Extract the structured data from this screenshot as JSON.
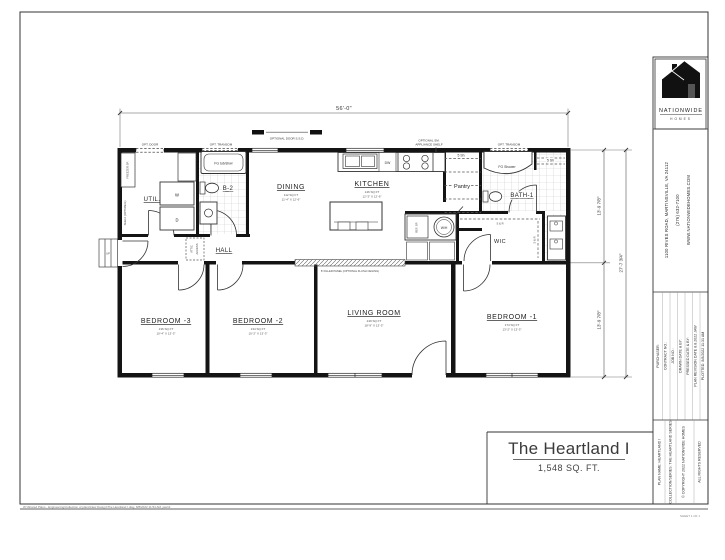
{
  "plan_title": {
    "name": "The Heartland I",
    "area": "1,548 SQ. FT."
  },
  "dims": {
    "width": "56'-0\"",
    "module_front": "13'-9 7/8\"",
    "module_rear": "13'-9 7/8\"",
    "overall_depth": "27'-7 3/4\""
  },
  "rooms": {
    "dining": {
      "label": "DINING",
      "area": "112 SQ FT",
      "size": "11'-4\" X 12'-6\""
    },
    "kitchen": {
      "label": "KITCHEN",
      "area": "146 SQ FT",
      "size": "12'-3\" X 12'-6\""
    },
    "living": {
      "label": "LIVING ROOM",
      "area": "249 SQ FT",
      "size": "18'-9\" X 13'-3\""
    },
    "bed1": {
      "label": "BEDROOM -1",
      "area": "174 SQ FT",
      "size": "13'-2\" X 13'-3\""
    },
    "bed2": {
      "label": "BEDROOM -2",
      "area": "134 SQ FT",
      "size": "10'-2\" X 13'-3\""
    },
    "bed3": {
      "label": "BEDROOM -3",
      "area": "136 SQ FT",
      "size": "10'-4\" X 13'-3\""
    },
    "util": {
      "label": "UTIL."
    },
    "hall": {
      "label": "HALL"
    },
    "b2": {
      "label": "B-2"
    },
    "bath1": {
      "label": "BATH-1"
    },
    "wic": {
      "label": "WIC"
    },
    "pantry": {
      "label": "Pantry"
    }
  },
  "fixtures": {
    "washer": "W",
    "dryer": "D",
    "dishwasher": "DW",
    "water_heater": "W/H",
    "fridge": "REF. SP.",
    "tub": "FG tub/shwr",
    "shower": "FG Shower",
    "shelves_5": "5 Sh",
    "shelf_rod": "S & R",
    "attic_1": "ATTIC",
    "attic_2": "ACCESS",
    "up": "UP",
    "freezer": "FREEZER SP.",
    "shelf_opt": "SHELF (OPTIONAL)"
  },
  "notes": {
    "opt_door_ssd": "OPTIONAL DOOR S.S.D.",
    "appliance_1": "OPTIONAL SM.",
    "appliance_2": "APPLIANCE SHELF",
    "filler": "8' FILLER PANEL (OPTIONAL FLUSH CEILING)",
    "opt_door": "OPT. DOOR",
    "opt_transom": "OPT. TRANSOM"
  },
  "title_block": {
    "brand": {
      "name": "NATIONWIDE",
      "sub": "HOMES"
    },
    "address_1": "1100 RIVES ROAD, MARTINSVILLE, VA 24112",
    "address_2": "(276) 632-7100",
    "address_3": "WWW.NATIONWIDEHOMES.COM",
    "fields": {
      "purchaser": "PURCHASER:",
      "contract": "CONTRACT NO.:",
      "job": "JOB NO.:",
      "drawn": "DRAWN DATE & BY:",
      "pressed": "PRESSED DATE & BY:",
      "revision": "PLAN REVISION DATE  8.8.2022   JAW",
      "plotted": "PLOTTED: 8/8/2022 11:31 AM"
    },
    "plan_name": "PLAN NAME:  HEARTLAND I",
    "series": "COLLECTION/SERIES:  THE HEARTLAND SERIES",
    "copyright": "© COPYRIGHT 2022 NATIONWIDE HOMES",
    "rights": "ALL RIGHTS RESERVED"
  },
  "footer": {
    "path": "W:\\Shared Plans - Engineering\\Collection of plans\\New Design\\The Heartland I.dwg, 8/8/2022 11:54 AM, jaw14",
    "sheet": "SHEET 1 OF 1"
  }
}
